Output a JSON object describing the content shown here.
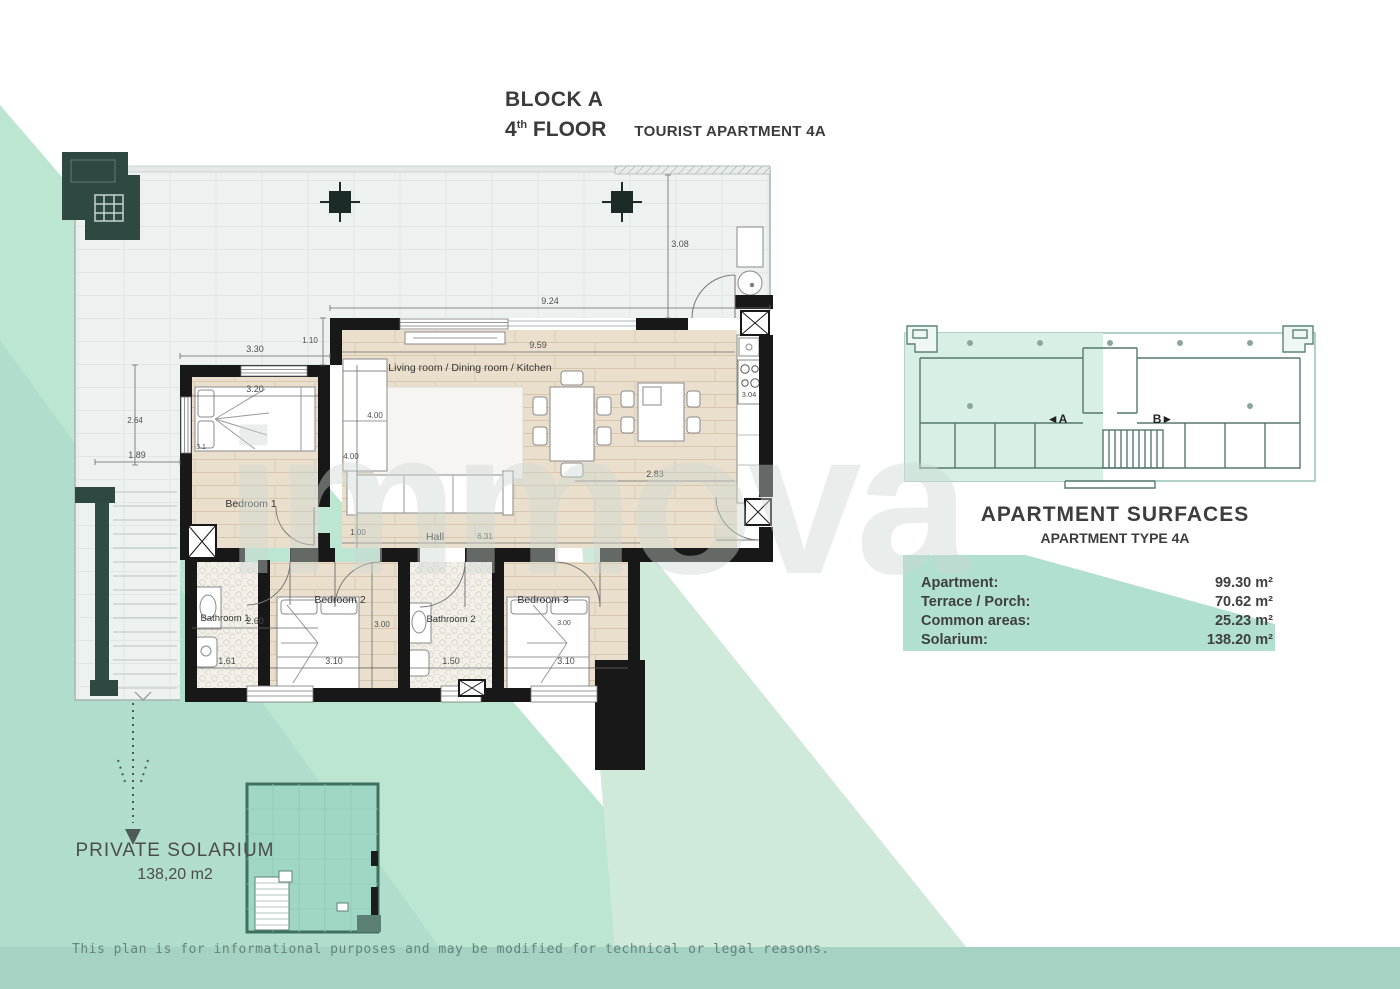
{
  "header": {
    "block": "BLOCK A",
    "floor_number": "4",
    "floor_ordinal": "th",
    "floor_word": "FLOOR",
    "apartment_type": "TOURIST APARTMENT 4A"
  },
  "watermark": "immova",
  "disclaimer": "This plan is for informational purposes and may be modified for technical or legal reasons.",
  "colors": {
    "accent_green": "#9ed8c4",
    "background_green": "#bce5d2",
    "wall_black": "#181818",
    "wood_floor": "#eadfcd"
  },
  "floor_plan": {
    "rooms": {
      "living": "Living room / Dining room / Kitchen",
      "hall": "Hall",
      "bedroom1": "Bedroom 1",
      "bedroom2": "Bedroom 2",
      "bedroom3": "Bedroom 3",
      "bathroom1": "Bathroom 1",
      "bathroom2": "Bathroom 2"
    },
    "dimensions": {
      "bedroom1_top_outer": "3.30",
      "terrace_offset": "1.10",
      "living_top_outer": "9.24",
      "terrace_depth": "3.08",
      "living_top_inner": "9.59",
      "bedroom1_width": "3.20",
      "bedroom1_depth": "4.00",
      "living_left_depth": "4.00",
      "kitchen_depth": "3.04",
      "terrace_left_depth": "2.64",
      "terrace_left_width": "1.89",
      "bed1_width": "3.1",
      "bedroom1_bottom": "2.60",
      "hall_entry": "1.00",
      "hall_length": "6.31",
      "bedrooms_depth": "3.00",
      "bedroom3_bed": "3.00",
      "bathroom1_width": "1.61",
      "bedroom2_width": "3.10",
      "bathroom2_width": "1.50",
      "bedroom3_width": "3.10",
      "entrance_width": "2.83"
    },
    "solarium_callout": {
      "title": "PRIVATE SOLARIUM",
      "area": "138,20 m2"
    }
  },
  "key_plan": {
    "unit_a_label": "◄A",
    "unit_b_label": "B►"
  },
  "surfaces_panel": {
    "title": "APARTMENT SURFACES",
    "subtitle": "APARTMENT TYPE 4A",
    "rows": [
      {
        "label": "Apartment:",
        "value": "99.30 m²"
      },
      {
        "label": "Terrace / Porch:",
        "value": "70.62 m²"
      },
      {
        "label": "Common areas:",
        "value": "25.23 m²"
      },
      {
        "label": "Solarium:",
        "value": "138.20 m²"
      }
    ]
  }
}
